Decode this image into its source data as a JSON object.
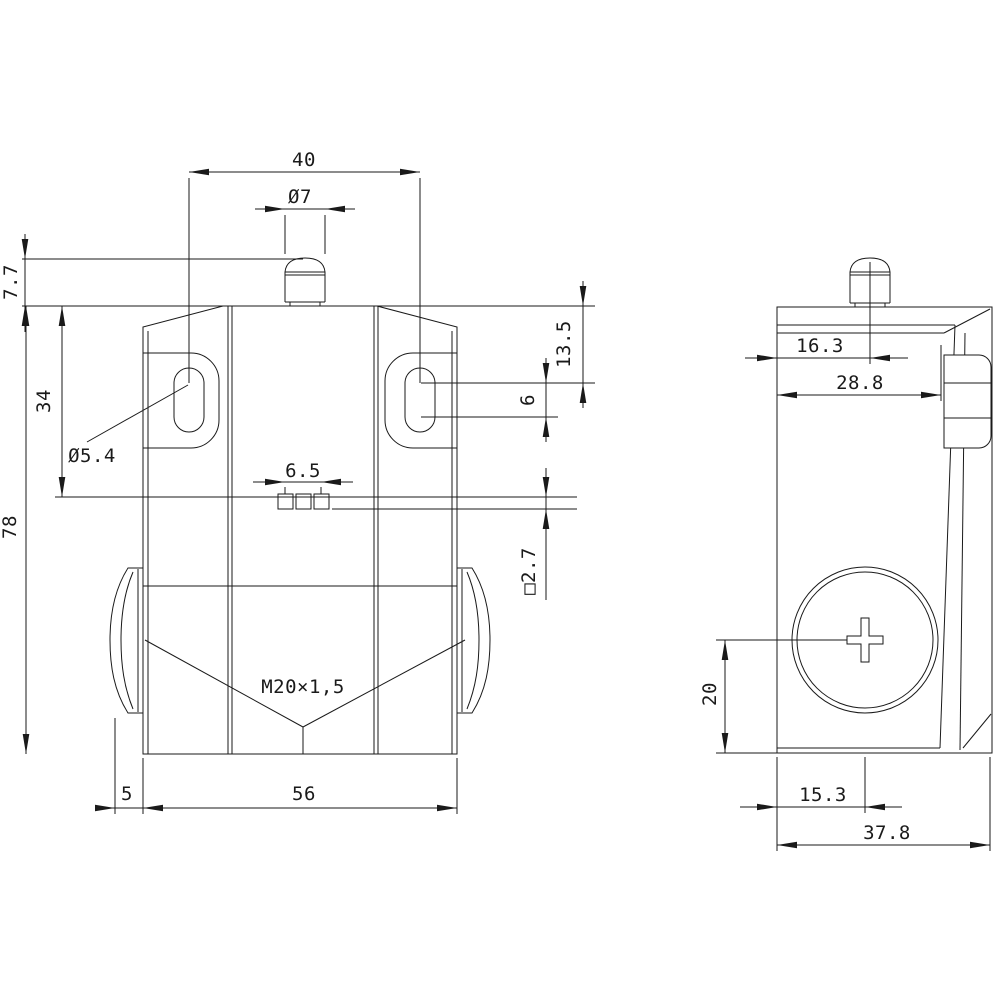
{
  "drawing": {
    "kind": "technical-dimension-drawing",
    "background_color": "#ffffff",
    "line_color": "#1a1a1a",
    "front_view": {
      "dims": {
        "hole_spacing": "40",
        "plunger_dia": "Ø7",
        "plunger_height": "7.7",
        "hole_center_from_top": "34",
        "hole_dia": "Ø5.4",
        "body_height": "78",
        "terminal_pitch": "6.5",
        "slot_top_offset": "13.5",
        "slot_length": "6",
        "terminal_square": "□2.7",
        "conduit_thread": "M20×1,5",
        "cap_protrusion": "5",
        "body_width": "56"
      }
    },
    "side_view": {
      "dims": {
        "plunger_from_front": "16.3",
        "front_depth": "28.8",
        "screw_center_from_bottom": "20",
        "screw_center_from_front": "15.3",
        "overall_depth": "37.8"
      }
    }
  }
}
